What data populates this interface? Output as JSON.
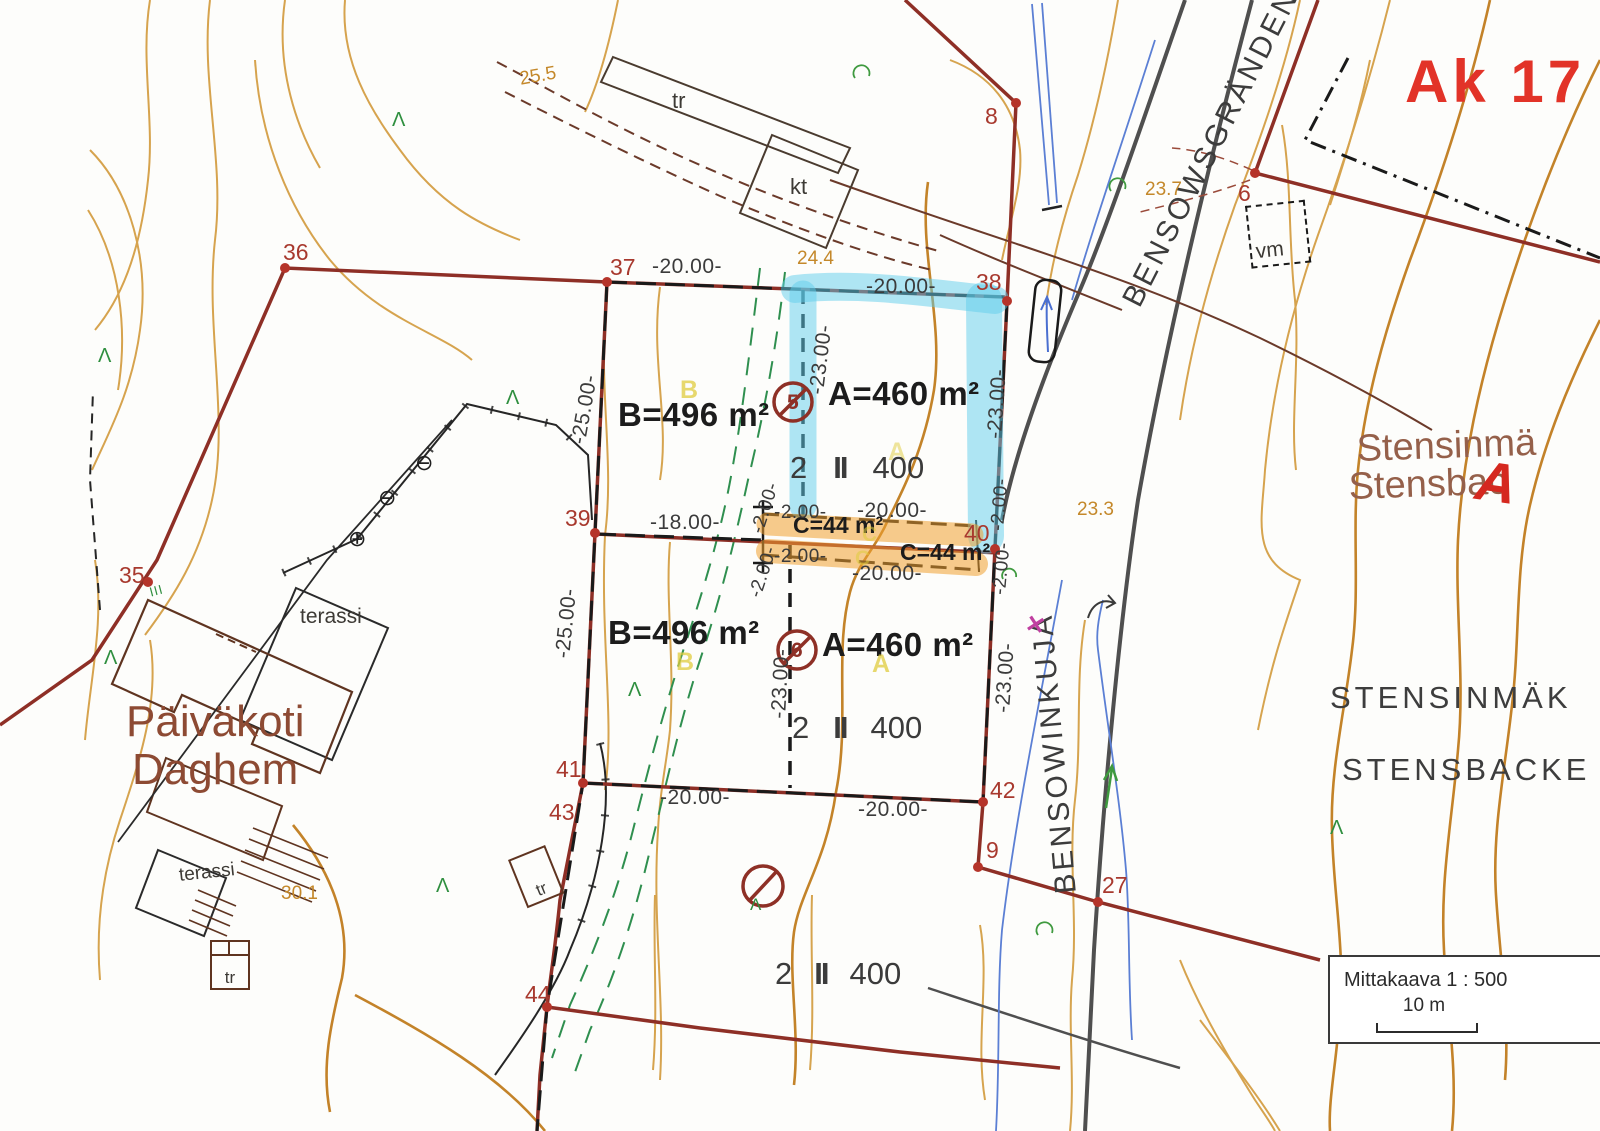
{
  "plan_code": "Ak 17",
  "streets": {
    "bensowsgranden": "BENSOWSGRÄNDEN",
    "bensowinkuja": "BENSOWINKUJA"
  },
  "places": {
    "paivakoti": "Päiväkoti",
    "daghem": "Daghem",
    "stensinmaki": "Stensinmä",
    "stensbacka": "Stensbac",
    "stensinmaki_caps": "STENSINMÄK",
    "stensbacka_caps": "STENSBACKE",
    "overlay_letter_a": "A"
  },
  "areas": {
    "a": "A=460 m²",
    "b": "B=496 m²",
    "c": "C=44 m²",
    "letter_a": "A",
    "letter_b": "B",
    "letter_c": "C"
  },
  "plot_info": {
    "plot_number": "2",
    "floors": "II",
    "building_right": "400"
  },
  "dimensions": {
    "d20": "-20.00-",
    "d23": "-23.00-",
    "d25": "-25.00-",
    "d18": "-18.00-",
    "d2": "-2.00-"
  },
  "boundary_points": {
    "p6": "6",
    "p8": "8",
    "p9": "9",
    "p27": "27",
    "p35": "35",
    "p36": "36",
    "p37": "37",
    "p38": "38",
    "p39": "39",
    "p40": "40",
    "p41": "41",
    "p42": "42",
    "p43": "43",
    "p44": "44"
  },
  "spot_heights": {
    "h25_5": "25.5",
    "h24_4": "24.4",
    "h23_7": "23.7",
    "h23_3": "23.3",
    "h30_1": "30.1"
  },
  "building_labels": {
    "tr": "tr",
    "kt": "kt",
    "terassi": "terassi",
    "vm": "vm"
  },
  "removal_marks": {
    "m5": "5",
    "m6": "6"
  },
  "misc_symbols": {
    "lambda": "Λ",
    "iii": "III",
    "survey_minus": "⊖",
    "survey_plus": "⊕",
    "x_mark": "✕"
  },
  "scale_box": {
    "title": "Mittakaava 1 : 500",
    "bar_label": "10 m"
  },
  "colors": {
    "contour": "#d29a3c",
    "boundary": "#8e2f26",
    "parcel_line": "#1a1a1a",
    "road": "#4f4f4f",
    "water": "#5b7fd4",
    "vegetation_green": "#2f8f4f",
    "highlight_blue": "#5fcdec",
    "highlight_orange": "#f0a030",
    "label_red": "#a8392e",
    "plan_red": "#e23328",
    "spot_height_orange": "#c4882a",
    "text_dark": "#3b3b3b",
    "place_brown": "#8d4a33",
    "yellow_letter": "#e0cc3e",
    "magenta": "#c03fa0"
  }
}
